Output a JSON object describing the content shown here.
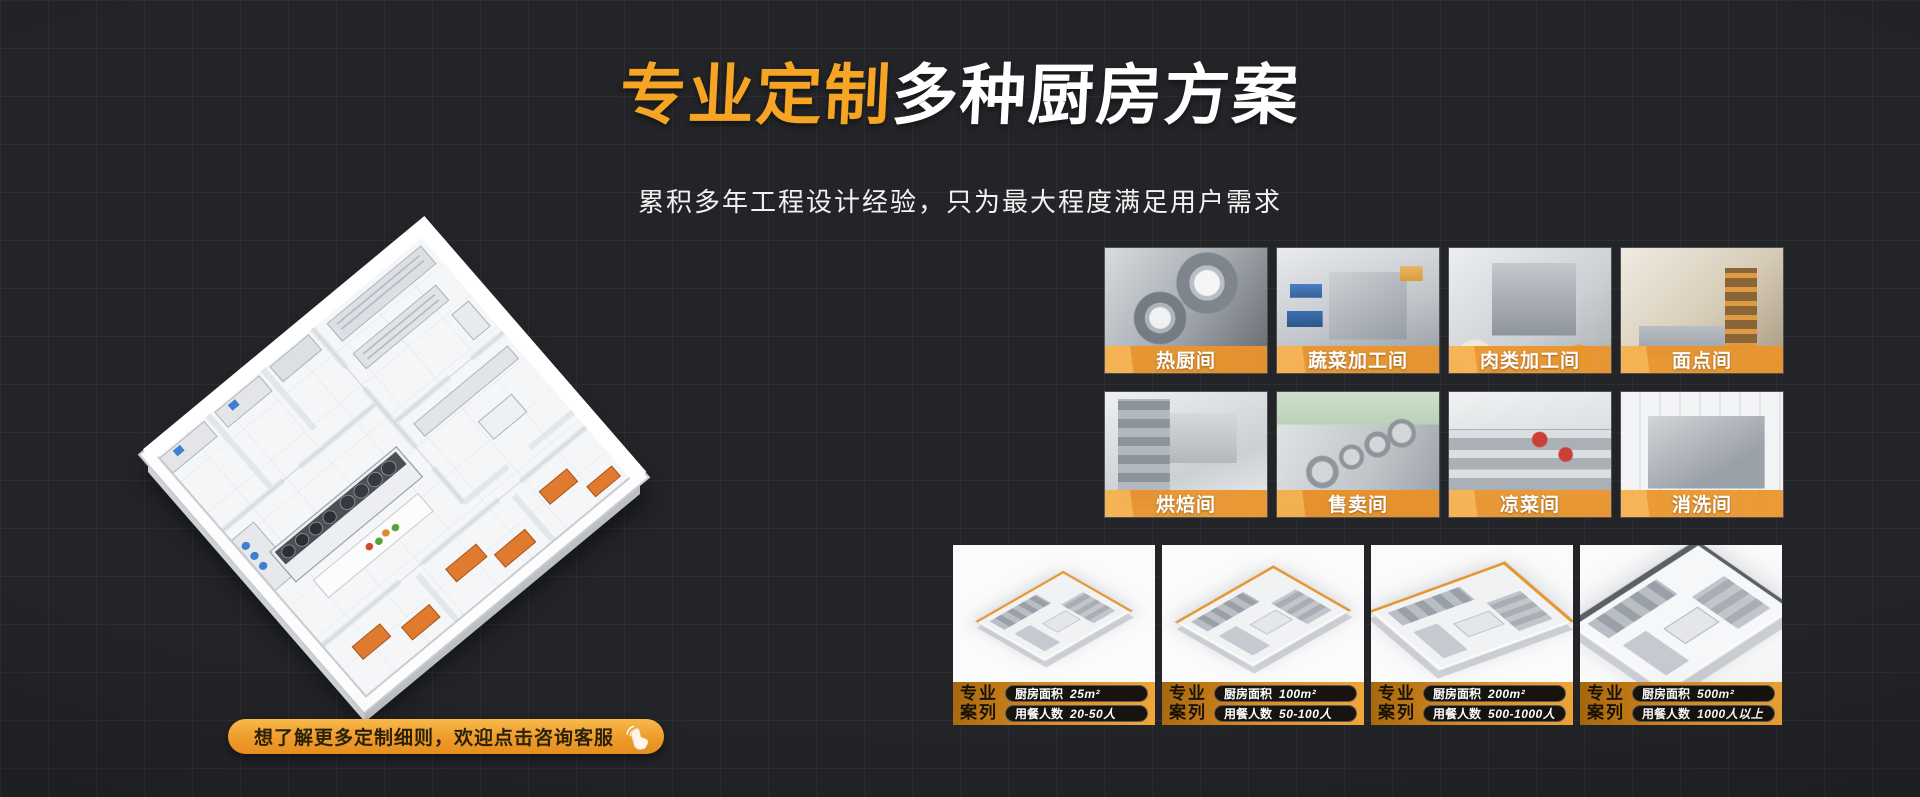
{
  "colors": {
    "background": "#232428",
    "accent_orange": "#F5A424",
    "strip_orange": "#E9942D",
    "pill_dark": "#17130E"
  },
  "hero": {
    "title_highlight": "专业定制",
    "title_rest": "多种厨房方案",
    "subtitle": "累积多年工程设计经验，只为最大程度满足用户需求"
  },
  "cta": {
    "label": "想了解更多定制细则，欢迎点击咨询客服",
    "icon": "click-hand-icon"
  },
  "rooms": [
    {
      "label": "热厨间"
    },
    {
      "label": "蔬菜加工间"
    },
    {
      "label": "肉类加工间"
    },
    {
      "label": "面点间"
    },
    {
      "label": "烘焙间"
    },
    {
      "label": "售卖间"
    },
    {
      "label": "凉菜间"
    },
    {
      "label": "消洗间"
    }
  ],
  "cases": [
    {
      "tag_line1": "专业",
      "tag_line2": "案列",
      "area_label": "厨房面积",
      "area_value": "25m²",
      "people_label": "用餐人数",
      "people_value": "20-50人"
    },
    {
      "tag_line1": "专业",
      "tag_line2": "案列",
      "area_label": "厨房面积",
      "area_value": "100m²",
      "people_label": "用餐人数",
      "people_value": "50-100人"
    },
    {
      "tag_line1": "专业",
      "tag_line2": "案列",
      "area_label": "厨房面积",
      "area_value": "200m²",
      "people_label": "用餐人数",
      "people_value": "500-1000人"
    },
    {
      "tag_line1": "专业",
      "tag_line2": "案列",
      "area_label": "厨房面积",
      "area_value": "500m²",
      "people_label": "用餐人数",
      "people_value": "1000人以上"
    }
  ]
}
